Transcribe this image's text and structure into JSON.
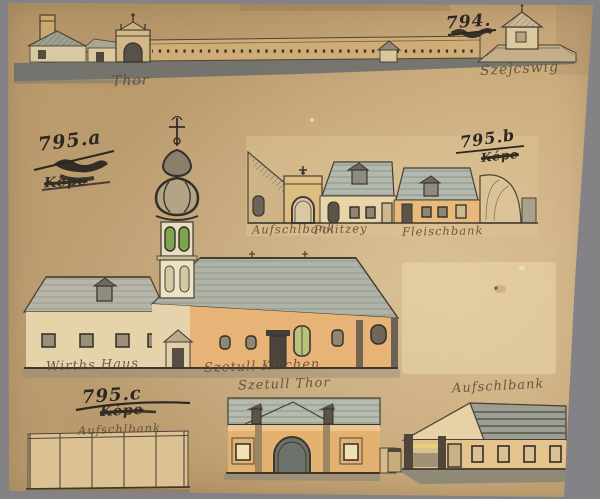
{
  "labels": {
    "top": {
      "number": "794.",
      "gate": "Thor",
      "right": "Szejcswig"
    },
    "a": {
      "number": "795.a",
      "sub": "Képe"
    },
    "b": {
      "number": "795.b",
      "sub": "Képe",
      "captions": [
        "Aufschlbank",
        "Politzey",
        "Fleischbank"
      ]
    },
    "main": {
      "left": "Wirths Haus",
      "right": "Szetull Kirchen"
    },
    "c": {
      "number": "795.c",
      "sub": "Képe"
    },
    "bottom": {
      "top": "Szetull Thor",
      "left": "Aufschlbank",
      "right": "Aufschlbank"
    }
  },
  "palette": {
    "mount_grey": "#828287",
    "paper_tan": "#c8a97a",
    "paper_light_patch": "#ecd9ad",
    "ink_dark": "#2c2721",
    "caption_brown": "#5d4a35",
    "wash_wall_orange": "#e5b377",
    "wash_roof_grey_green": "#b2b7aa",
    "wash_cream": "#e6d3ab",
    "window_green": "#7fa44f",
    "ground_wash": "#676c6e"
  }
}
